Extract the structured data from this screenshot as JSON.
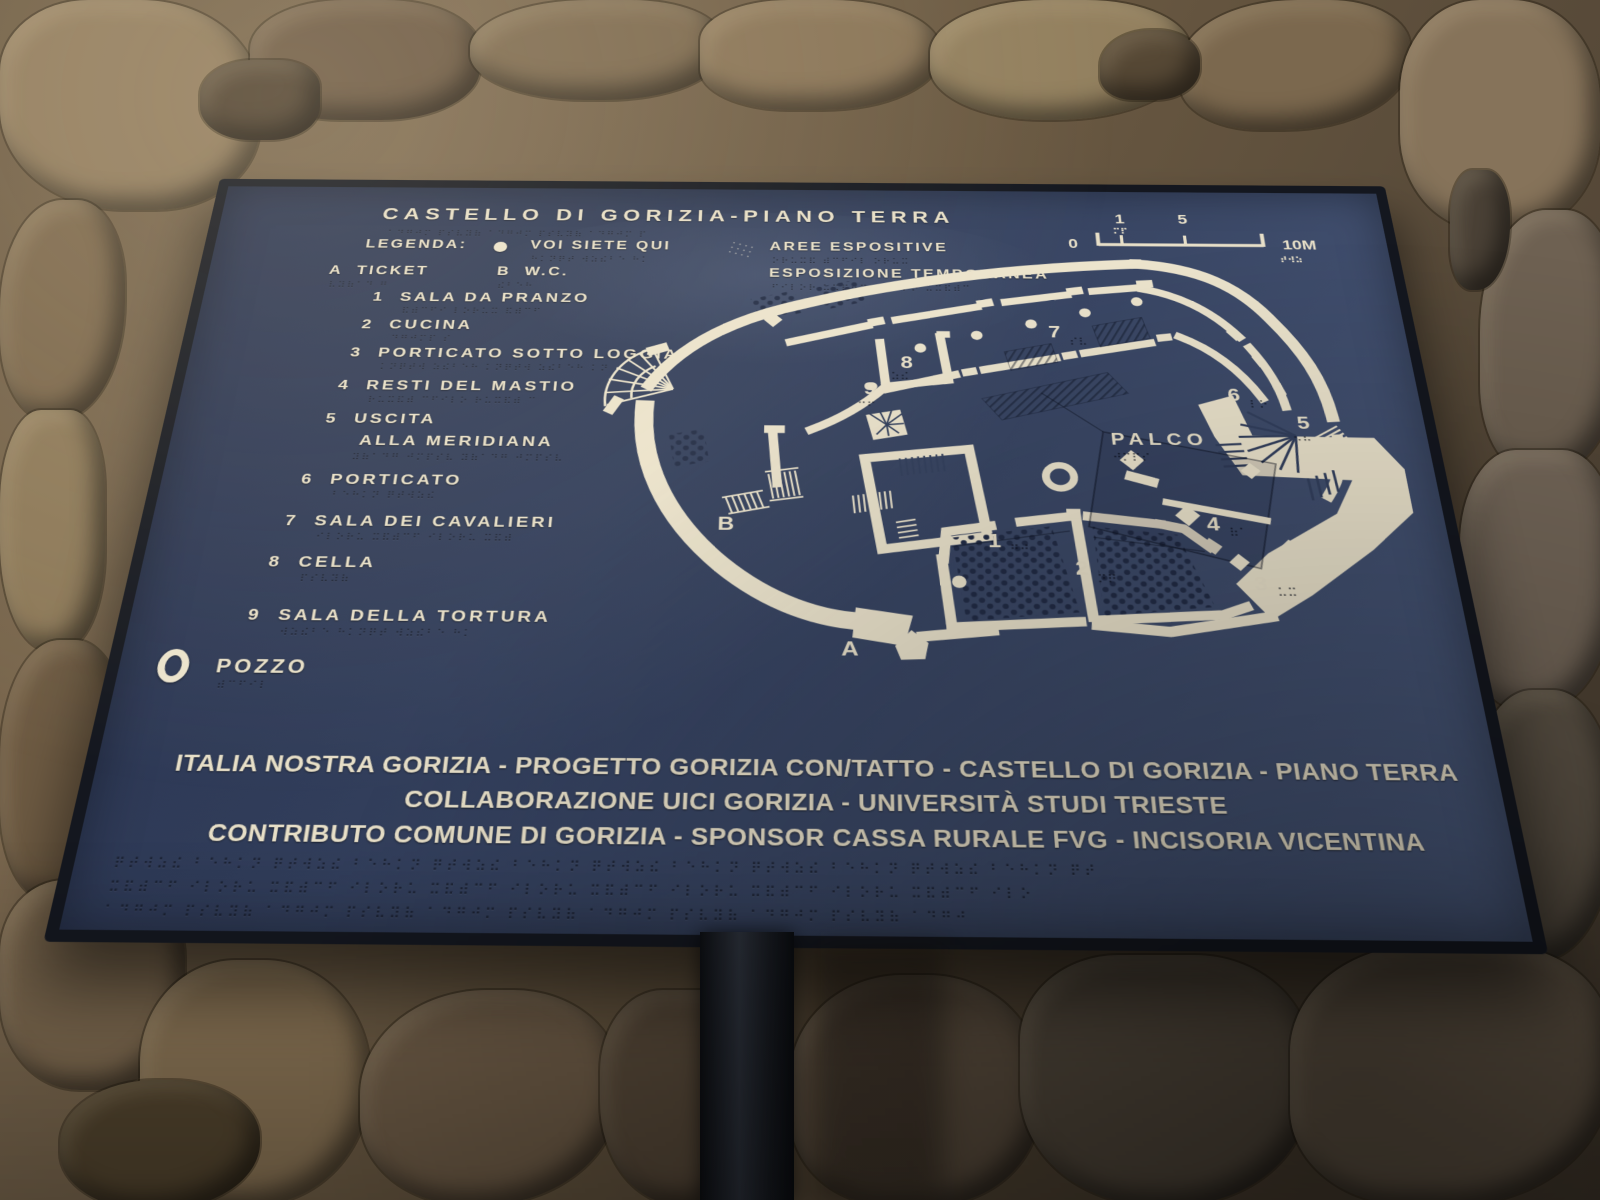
{
  "panel": {
    "title": "CASTELLO DI GORIZIA-PIANO TERRA",
    "legend": {
      "label": "LEGENDA:",
      "you_are_here": "VOI SIETE QUI",
      "ticket_key": "A",
      "ticket": "TICKET",
      "wc_key": "B",
      "wc": "W.C.",
      "expo_areas": "AREE ESPOSITIVE",
      "expo_temp": "ESPOSIZIONE TEMPORANEA"
    },
    "scalebar": {
      "zero": "0",
      "one": "1",
      "five": "5",
      "ten": "10M"
    },
    "rooms": [
      {
        "num": "1",
        "name": "SALA DA PRANZO"
      },
      {
        "num": "2",
        "name": "CUCINA"
      },
      {
        "num": "3",
        "name": "PORTICATO SOTTO LOGGIA"
      },
      {
        "num": "4",
        "name": "RESTI DEL MASTIO"
      },
      {
        "num": "5",
        "name": "USCITA",
        "name2": "ALLA MERIDIANA"
      },
      {
        "num": "6",
        "name": "PORTICATO"
      },
      {
        "num": "7",
        "name": "SALA DEI CAVALIERI"
      },
      {
        "num": "8",
        "name": "CELLA"
      },
      {
        "num": "9",
        "name": "SALA DELLA TORTURA"
      }
    ],
    "pozzo": {
      "label": "POZZO"
    },
    "map": {
      "palco": "PALCO",
      "n1": "1",
      "n2": "2",
      "n3": "3",
      "n4": "4",
      "n5": "5",
      "n6": "6",
      "n7": "7",
      "n8": "8",
      "n9": "9",
      "a": "A",
      "b": "B"
    },
    "footer": {
      "line1": "ITALIA NOSTRA GORIZIA - PROGETTO GORIZIA CON/TATTO - CASTELLO DI GORIZIA - PIANO TERRA",
      "line2": "COLLABORAZIONE UICI GORIZIA - UNIVERSITÀ STUDI TRIESTE",
      "line3": "CONTRIBUTO COMUNE DI GORIZIA - SPONSOR CASSA RURALE FVG - INCISORIA VICENTINA"
    },
    "colors": {
      "panel_navy": "#34405c",
      "wall_cream": "#ece4cd",
      "frame": "#14171f"
    }
  }
}
